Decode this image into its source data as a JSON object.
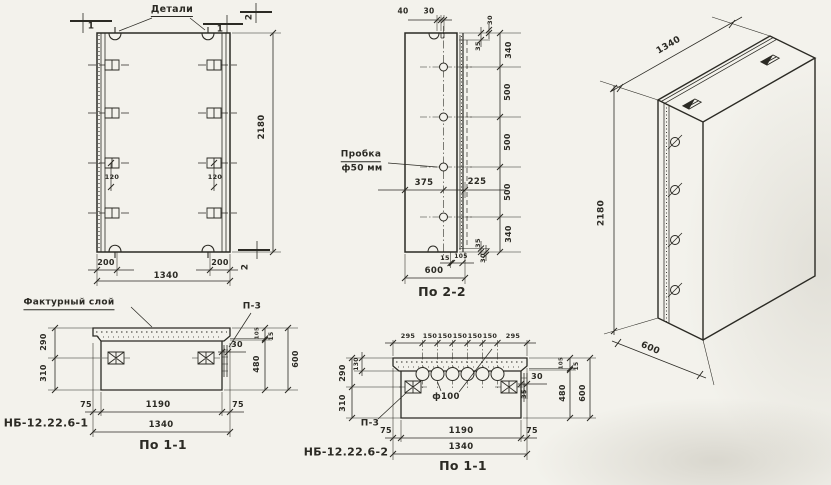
{
  "palette": {
    "paper": "#f3f2ec",
    "ink": "#2b2a24"
  },
  "drawing_type": "precast concrete panel working drawing",
  "views": [
    {
      "id": "front",
      "caption": "front elevation",
      "labels": [
        {
          "name": "callout-details",
          "text": "Детали",
          "x": 172,
          "y": 11,
          "fs": 9.5,
          "ul": true
        },
        {
          "name": "section-mark-1-left",
          "text": "1",
          "x": 91,
          "y": 27,
          "fs": 9
        },
        {
          "name": "section-mark-1-right",
          "text": "1",
          "x": 220,
          "y": 30,
          "fs": 9
        },
        {
          "name": "section-mark-2-top",
          "text": "2",
          "x": 250,
          "y": 17,
          "fs": 9,
          "rot": -90
        },
        {
          "name": "section-mark-2-bottom",
          "text": "2",
          "x": 246,
          "y": 267,
          "fs": 9,
          "rot": -90
        },
        {
          "name": "dim-120-left",
          "text": "120",
          "x": 112,
          "y": 177,
          "fs": 6.5
        },
        {
          "name": "dim-120-right",
          "text": "120",
          "x": 215,
          "y": 177,
          "fs": 6.5
        },
        {
          "name": "dim-200-left",
          "text": "200",
          "x": 106,
          "y": 263,
          "fs": 8
        },
        {
          "name": "dim-1340",
          "text": "1340",
          "x": 166,
          "y": 276,
          "fs": 8.5
        },
        {
          "name": "dim-200-right",
          "text": "200",
          "x": 220,
          "y": 263,
          "fs": 8
        },
        {
          "name": "dim-2180",
          "text": "2180",
          "x": 262,
          "y": 127,
          "fs": 8.5,
          "rot": -90
        }
      ]
    },
    {
      "id": "s22",
      "caption": "section 2-2",
      "labels": [
        {
          "name": "dim-40",
          "text": "40",
          "x": 403,
          "y": 11,
          "fs": 7.5
        },
        {
          "name": "dim-30-top",
          "text": "30",
          "x": 429,
          "y": 11,
          "fs": 7.5
        },
        {
          "name": "dim-30-upper-right",
          "text": "30",
          "x": 490,
          "y": 20,
          "fs": 6.5,
          "rot": -90
        },
        {
          "name": "dim-35-upper-right",
          "text": "35",
          "x": 478,
          "y": 46,
          "fs": 6.5,
          "rot": -90
        },
        {
          "name": "dim-340-top",
          "text": "340",
          "x": 509,
          "y": 50,
          "fs": 8,
          "rot": -90
        },
        {
          "name": "dim-500-1",
          "text": "500",
          "x": 508,
          "y": 92,
          "fs": 8,
          "rot": -90
        },
        {
          "name": "dim-500-2",
          "text": "500",
          "x": 508,
          "y": 142,
          "fs": 8,
          "rot": -90
        },
        {
          "name": "dim-500-3",
          "text": "500",
          "x": 508,
          "y": 192,
          "fs": 8,
          "rot": -90
        },
        {
          "name": "dim-340-bottom",
          "text": "340",
          "x": 509,
          "y": 234,
          "fs": 8,
          "rot": -90
        },
        {
          "name": "dim-375",
          "text": "375",
          "x": 424,
          "y": 183,
          "fs": 8.5
        },
        {
          "name": "dim-225",
          "text": "225",
          "x": 477,
          "y": 182,
          "fs": 8.5
        },
        {
          "name": "dim-35-lower-right",
          "text": "35",
          "x": 478,
          "y": 243,
          "fs": 6.5,
          "rot": -90
        },
        {
          "name": "dim-30-lower-right",
          "text": "30",
          "x": 483,
          "y": 258,
          "fs": 6.5,
          "rot": -90
        },
        {
          "name": "callout-plug-line1",
          "text": "Пробка",
          "x": 361,
          "y": 156,
          "fs": 9,
          "ul": true
        },
        {
          "name": "callout-plug-line2",
          "text": "ф50 мм",
          "x": 362,
          "y": 169,
          "fs": 9
        },
        {
          "name": "dim-15-bottom",
          "text": "15",
          "x": 445,
          "y": 258,
          "fs": 6.5
        },
        {
          "name": "dim-105-bottom",
          "text": "105",
          "x": 461,
          "y": 257,
          "fs": 6
        },
        {
          "name": "dim-600-bottom",
          "text": "600",
          "x": 434,
          "y": 271,
          "fs": 8.5
        },
        {
          "name": "view-title",
          "text": "По 2-2",
          "x": 442,
          "y": 292,
          "fs": 12.5
        }
      ]
    },
    {
      "id": "iso",
      "caption": "isometric view",
      "labels": [
        {
          "name": "dim-1340",
          "text": "1340",
          "x": 669,
          "y": 46,
          "fs": 9,
          "rot": -30
        },
        {
          "name": "dim-2180",
          "text": "2180",
          "x": 602,
          "y": 213,
          "fs": 9,
          "rot": -90
        },
        {
          "name": "dim-600",
          "text": "600",
          "x": 650,
          "y": 349,
          "fs": 9,
          "rot": 23
        }
      ]
    },
    {
      "id": "s11a",
      "caption": "section 1-1 of panel type 1",
      "labels": [
        {
          "name": "callout-facing-layer",
          "text": "Фактурный слой",
          "x": 69,
          "y": 304,
          "fs": 9,
          "ul": true
        },
        {
          "name": "callout-p3",
          "text": "П-3",
          "x": 252,
          "y": 307,
          "fs": 9
        },
        {
          "name": "dim-290",
          "text": "290",
          "x": 44,
          "y": 342,
          "fs": 8,
          "rot": -90
        },
        {
          "name": "dim-310",
          "text": "310",
          "x": 44,
          "y": 373,
          "fs": 8,
          "rot": -90
        },
        {
          "name": "dim-30",
          "text": "30",
          "x": 237,
          "y": 345,
          "fs": 8
        },
        {
          "name": "dim-105",
          "text": "105",
          "x": 258,
          "y": 333,
          "fs": 5.5,
          "rot": -90
        },
        {
          "name": "dim-15",
          "text": "15",
          "x": 272,
          "y": 336,
          "fs": 6,
          "rot": -90
        },
        {
          "name": "dim-480",
          "text": "480",
          "x": 257,
          "y": 364,
          "fs": 8,
          "rot": -90
        },
        {
          "name": "dim-600",
          "text": "600",
          "x": 296,
          "y": 359,
          "fs": 8,
          "rot": -90
        },
        {
          "name": "dim-75-left",
          "text": "75",
          "x": 86,
          "y": 405,
          "fs": 8
        },
        {
          "name": "dim-1190",
          "text": "1190",
          "x": 158,
          "y": 405,
          "fs": 8.5
        },
        {
          "name": "dim-75-right",
          "text": "75",
          "x": 238,
          "y": 405,
          "fs": 8
        },
        {
          "name": "dim-1340",
          "text": "1340",
          "x": 161,
          "y": 425,
          "fs": 8.5
        },
        {
          "name": "panel-mark",
          "text": "НБ-12.22.6-1",
          "x": 46,
          "y": 423,
          "fs": 11
        },
        {
          "name": "view-title",
          "text": "По 1-1",
          "x": 163,
          "y": 445,
          "fs": 12.5
        }
      ]
    },
    {
      "id": "s11b",
      "caption": "section 1-1 of panel type 2",
      "labels": [
        {
          "name": "dim-295-left",
          "text": "295",
          "x": 408,
          "y": 336,
          "fs": 6.5
        },
        {
          "name": "dim-150-1",
          "text": "150",
          "x": 430,
          "y": 336,
          "fs": 6.5
        },
        {
          "name": "dim-150-2",
          "text": "150",
          "x": 445,
          "y": 336,
          "fs": 6.5
        },
        {
          "name": "dim-150-3",
          "text": "150",
          "x": 460,
          "y": 336,
          "fs": 6.5
        },
        {
          "name": "dim-150-4",
          "text": "150",
          "x": 475,
          "y": 336,
          "fs": 6.5
        },
        {
          "name": "dim-150-5",
          "text": "150",
          "x": 490,
          "y": 336,
          "fs": 6.5
        },
        {
          "name": "dim-295-right",
          "text": "295",
          "x": 513,
          "y": 336,
          "fs": 6.5
        },
        {
          "name": "dim-130",
          "text": "130",
          "x": 357,
          "y": 364,
          "fs": 6,
          "rot": -90
        },
        {
          "name": "dim-290",
          "text": "290",
          "x": 343,
          "y": 373,
          "fs": 8,
          "rot": -90
        },
        {
          "name": "dim-310",
          "text": "310",
          "x": 343,
          "y": 403,
          "fs": 8,
          "rot": -90
        },
        {
          "name": "dim-hole-diameter",
          "text": "ф100",
          "x": 446,
          "y": 397,
          "fs": 8.5
        },
        {
          "name": "callout-p3",
          "text": "П-3",
          "x": 370,
          "y": 424,
          "fs": 9
        },
        {
          "name": "dim-30",
          "text": "30",
          "x": 537,
          "y": 377,
          "fs": 8
        },
        {
          "name": "dim-35",
          "text": "35",
          "x": 524,
          "y": 394,
          "fs": 6.5,
          "rot": -90
        },
        {
          "name": "dim-105",
          "text": "105",
          "x": 562,
          "y": 363,
          "fs": 5.5,
          "rot": -90
        },
        {
          "name": "dim-15",
          "text": "15",
          "x": 577,
          "y": 366,
          "fs": 6,
          "rot": -90
        },
        {
          "name": "dim-480",
          "text": "480",
          "x": 563,
          "y": 393,
          "fs": 8,
          "rot": -90
        },
        {
          "name": "dim-600",
          "text": "600",
          "x": 583,
          "y": 393,
          "fs": 8,
          "rot": -90
        },
        {
          "name": "dim-75-left",
          "text": "75",
          "x": 386,
          "y": 431,
          "fs": 8
        },
        {
          "name": "dim-1190",
          "text": "1190",
          "x": 461,
          "y": 431,
          "fs": 8.5
        },
        {
          "name": "dim-75-right",
          "text": "75",
          "x": 532,
          "y": 431,
          "fs": 8
        },
        {
          "name": "dim-1340",
          "text": "1340",
          "x": 461,
          "y": 447,
          "fs": 8.5
        },
        {
          "name": "panel-mark",
          "text": "НБ-12.22.6-2",
          "x": 346,
          "y": 452,
          "fs": 11
        },
        {
          "name": "view-title",
          "text": "По 1-1",
          "x": 463,
          "y": 466,
          "fs": 12.5
        }
      ]
    }
  ]
}
